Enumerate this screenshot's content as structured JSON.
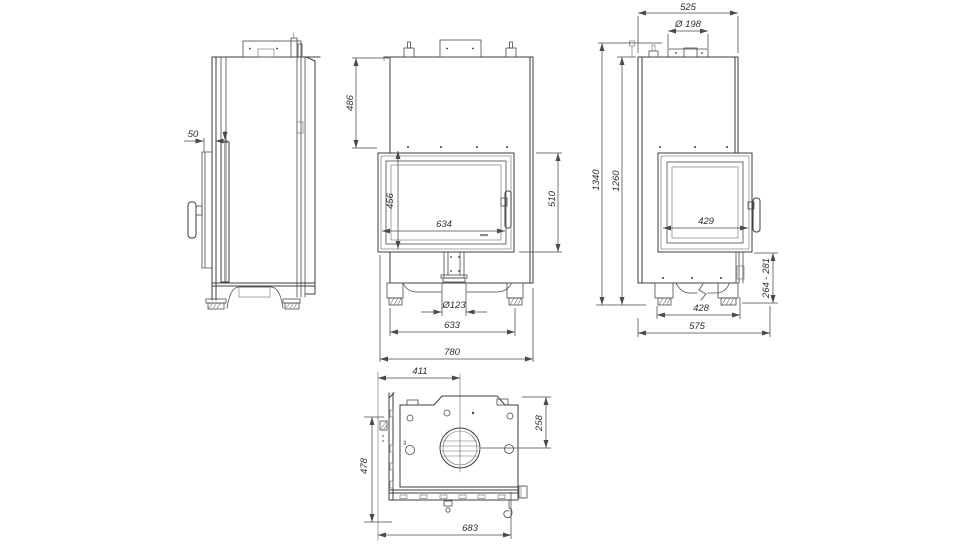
{
  "drawing": {
    "kind": "fireplace-insert-technical-drawing",
    "colors": {
      "background": "#ffffff",
      "line": "#3e3e3e",
      "dimension": "#4a4a4a"
    },
    "views": {
      "side": {
        "label": "left-side-view",
        "dims": {
          "door_offset": "50"
        }
      },
      "front": {
        "label": "front-view",
        "dims": {
          "hood_height": "486",
          "glass_height": "456",
          "glass_width": "634",
          "door_height": "510",
          "inlet_diameter": "Ø123",
          "feet_spacing": "633",
          "overall_width": "780"
        }
      },
      "right": {
        "label": "right-side-view",
        "dims": {
          "top_depth": "525",
          "flue_diameter": "Ø 198",
          "overall_height": "1340",
          "body_height": "1260",
          "side_glass_width": "429",
          "plinth_height_range": "264 - 281",
          "feet_spacing": "428",
          "overall_depth": "575"
        }
      },
      "top": {
        "label": "top-view",
        "dims": {
          "flue_center_from_left": "411",
          "flue_center_from_front": "258",
          "body_depth": "478",
          "overall_width": "683"
        }
      }
    }
  }
}
